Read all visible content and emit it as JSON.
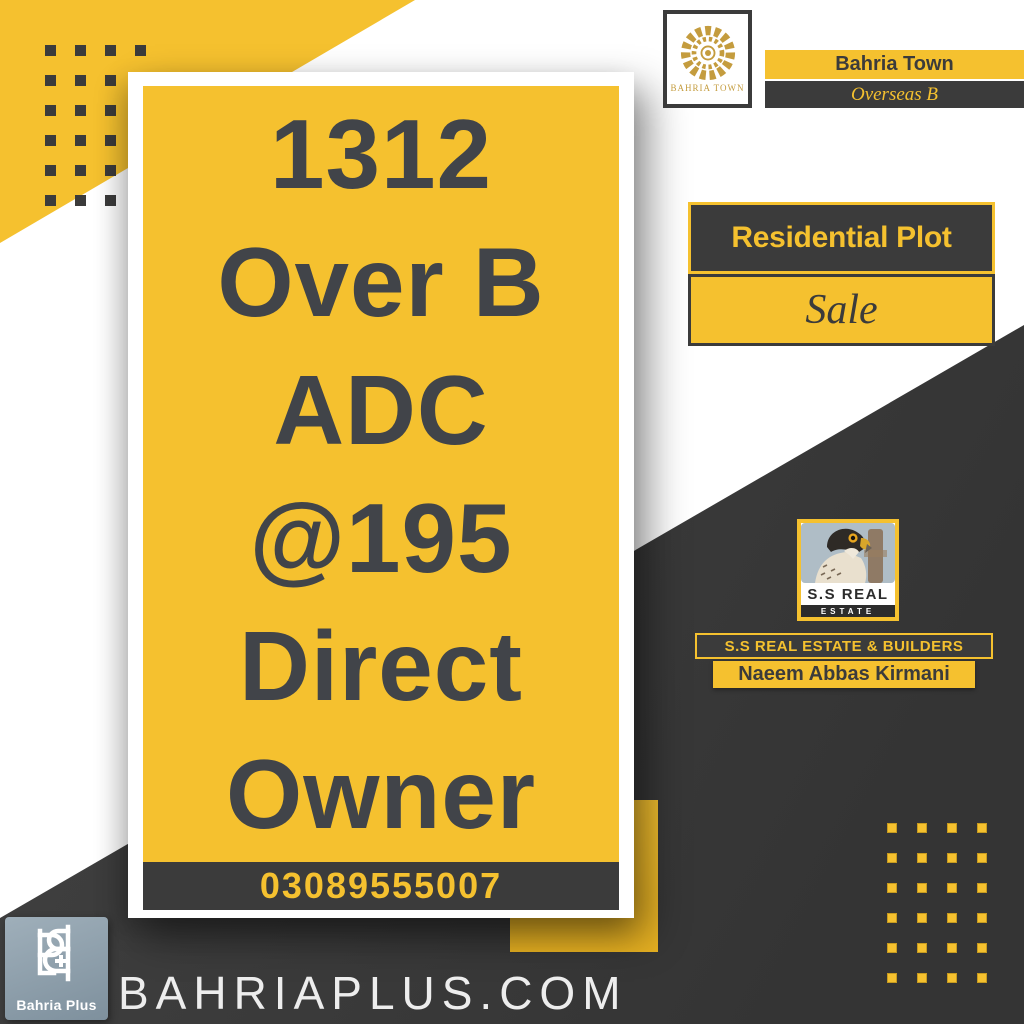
{
  "card": {
    "headline_lines": [
      "1312",
      "Over B",
      "ADC",
      "@195",
      "Direct",
      "Owner"
    ],
    "phone": "03089555007"
  },
  "developer_badge": {
    "logo_caption": "BAHRIA TOWN",
    "name": "Bahria Town",
    "phase": "Overseas B"
  },
  "listing_badge": {
    "category": "Residential Plot",
    "status": "Sale"
  },
  "agency": {
    "logo_title": "S.S REAL",
    "logo_subtitle": "ESTATE",
    "banner": "S.S REAL ESTATE & BUILDERS",
    "agent_name": "Naeem Abbas Kirmani"
  },
  "footer": {
    "brand_caption": "Bahria Plus",
    "website": "BAHRIAPLUS.COM"
  },
  "decor": {
    "top_left_dots": {
      "rows": 6,
      "cols": 4
    },
    "bottom_right_dots": {
      "rows": 6,
      "cols": 4
    }
  },
  "colors": {
    "accent_yellow": "#F5C12F",
    "charcoal": "#3B3B3B",
    "logo_gold": "#C49C3E",
    "footer_logo_slate": "#8C9DA9",
    "headline_text": "#414449"
  }
}
